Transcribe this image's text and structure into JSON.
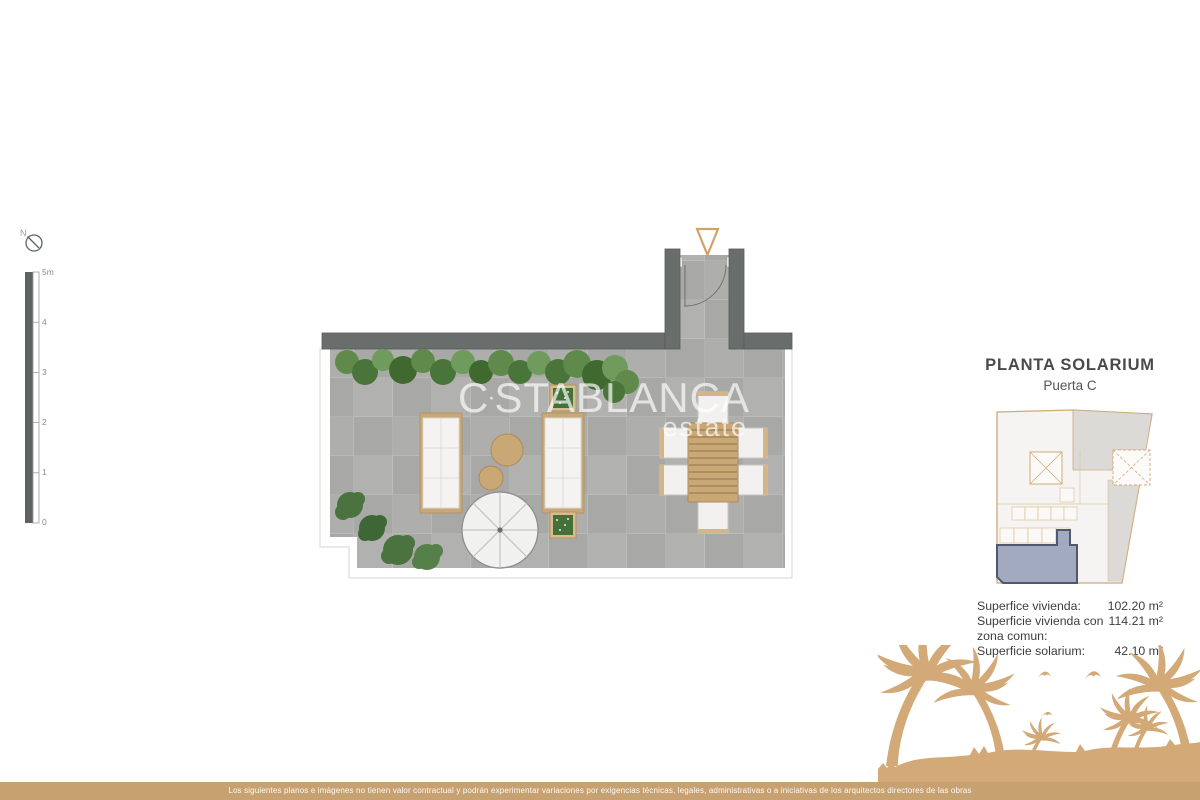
{
  "colors": {
    "accent_tan": "#c9a876",
    "wall_gray": "#696e6d",
    "floor_gray": "#aeaeac",
    "plant_green": "#5f8a4c",
    "highlight_unit_fill": "#9aa3bc",
    "highlight_unit_border": "#4e586e",
    "palm_tan": "#d2a977",
    "bottom_bar_tan": "#c7a170",
    "watermark_white": "#ffffff"
  },
  "icons": {
    "north": "compass-icon",
    "entrance": "entrance-arrow-icon",
    "watermark_sun": "sun-icon",
    "beach": "palm-beach-illustration"
  },
  "compass": {
    "north_label": "N"
  },
  "scale_bar": {
    "ticks": [
      "5m",
      "4",
      "3",
      "2",
      "1",
      "0"
    ]
  },
  "watermark": {
    "prefix": "C",
    "suffix": "STABLANCA",
    "subtitle": "estate"
  },
  "title_block": {
    "title": "PLANTA SOLARIUM",
    "subtitle": "Puerta C"
  },
  "surfaces": {
    "rows": [
      {
        "label": "Superfice vivienda:",
        "value": "102.20 m²"
      },
      {
        "label": "Superficie vivienda con",
        "value": "114.21 m²"
      },
      {
        "label": "zona comun:",
        "value": ""
      },
      {
        "label": "Superficie solarium:",
        "value": "42.10 m²"
      }
    ]
  },
  "disclaimer": {
    "text": "Los siguientes planos e imágenes no tienen valor contractual y podrán experimentar variaciones por exigencias técnicas, legales, administrativas o a iniciativas de los arquitectos directores de las obras"
  }
}
